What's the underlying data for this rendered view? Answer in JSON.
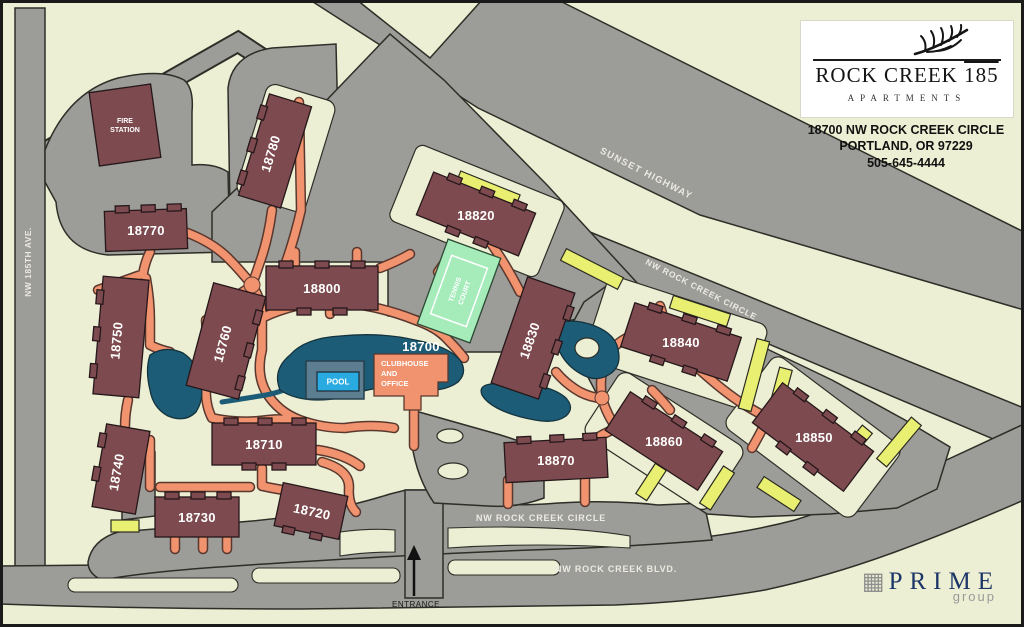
{
  "map": {
    "background_color": "#ecefd3",
    "colors": {
      "road": "#9c9c98",
      "building": "#7d4b4f",
      "walkway": "#f0936e",
      "pond": "#1d5c76",
      "pool": "#29abe2",
      "pool_deck": "#5d7d90",
      "tennis_court": "#a5ecba",
      "carport": "#e9ef70",
      "clubhouse": "#f0936e",
      "building_label": "#ffffff",
      "road_label": "#eceae2",
      "logo_navy": "#1d3668"
    },
    "header": {
      "leaf_icon": "fern-leaf-icon",
      "brand_name": "ROCK CREEK",
      "brand_number": "185",
      "brand_subtitle": "APARTMENTS",
      "address_lines": [
        "18700 NW ROCK CREEK CIRCLE",
        "PORTLAND, OR 97229",
        "505-645-4444"
      ]
    },
    "roads": {
      "nw_185th_ave": "NW 185TH AVE.",
      "sunset_highway": "SUNSET HIGHWAY",
      "nw_rock_creek_circle_upper": "NW ROCK CREEK CIRCLE",
      "nw_rock_creek_circle_lower": "NW ROCK CREEK CIRCLE",
      "nw_rock_creek_blvd": "NW ROCK CREEK BLVD.",
      "entrance": "ENTRANCE"
    },
    "buildings": [
      {
        "label": "18780"
      },
      {
        "label": "18770"
      },
      {
        "label": "18750"
      },
      {
        "label": "18740"
      },
      {
        "label": "18760"
      },
      {
        "label": "18800"
      },
      {
        "label": "18820"
      },
      {
        "label": "18830"
      },
      {
        "label": "18840"
      },
      {
        "label": "18850"
      },
      {
        "label": "18860"
      },
      {
        "label": "18870"
      },
      {
        "label": "18710"
      },
      {
        "label": "18720"
      },
      {
        "label": "18730"
      }
    ],
    "clubhouse": {
      "number": "18700",
      "name_lines": [
        "CLUBHOUSE",
        "AND",
        "OFFICE"
      ]
    },
    "fire_station": {
      "name_lines": [
        "FIRE",
        "STATION"
      ]
    },
    "amenities": {
      "pool_label": "POOL",
      "tennis_lines": [
        "TENNIS",
        "COURT"
      ]
    },
    "footer_logo": {
      "icon": "building-grid-icon",
      "name": "PRIME",
      "subtitle": "group"
    }
  }
}
